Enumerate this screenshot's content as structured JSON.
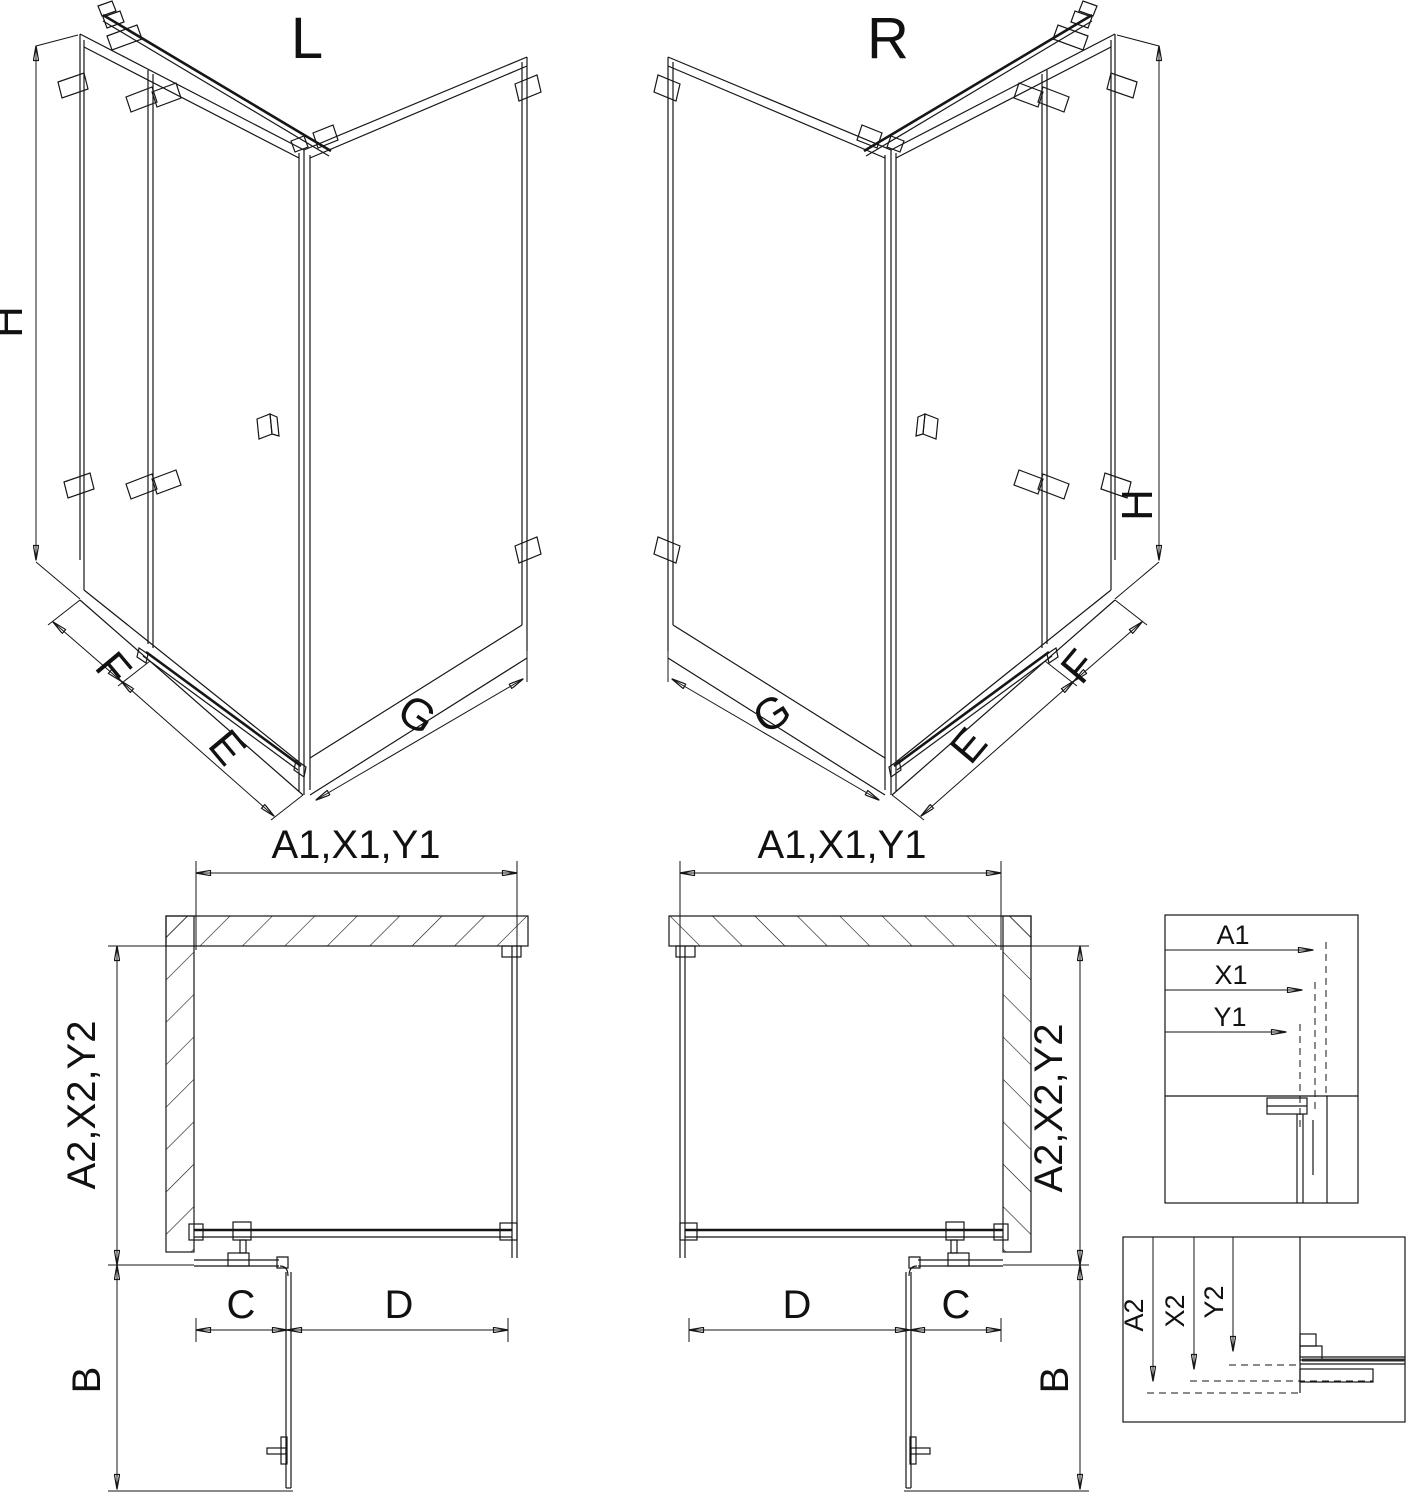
{
  "colors": {
    "background": "#ffffff",
    "line": "#161616",
    "text": "#111111"
  },
  "views": {
    "iso_left": {
      "title": "L",
      "height_label": "H",
      "fixed_panel_label": "F",
      "door_label": "E",
      "side_panel_label": "G"
    },
    "iso_right": {
      "title": "R",
      "height_label": "H",
      "fixed_panel_label": "F",
      "door_label": "E",
      "side_panel_label": "G"
    },
    "plan_left": {
      "width_label": "A1,X1,Y1",
      "depth_label": "A2,X2,Y2",
      "fixed_segment_label": "C",
      "door_segment_label": "D",
      "door_projection_label": "B"
    },
    "plan_right": {
      "width_label": "A1,X1,Y1",
      "depth_label": "A2,X2,Y2",
      "fixed_segment_label": "C",
      "door_segment_label": "D",
      "door_projection_label": "B"
    },
    "detail_width": {
      "labels": [
        "A1",
        "X1",
        "Y1"
      ]
    },
    "detail_depth": {
      "labels": [
        "A2",
        "X2",
        "Y2"
      ]
    }
  }
}
